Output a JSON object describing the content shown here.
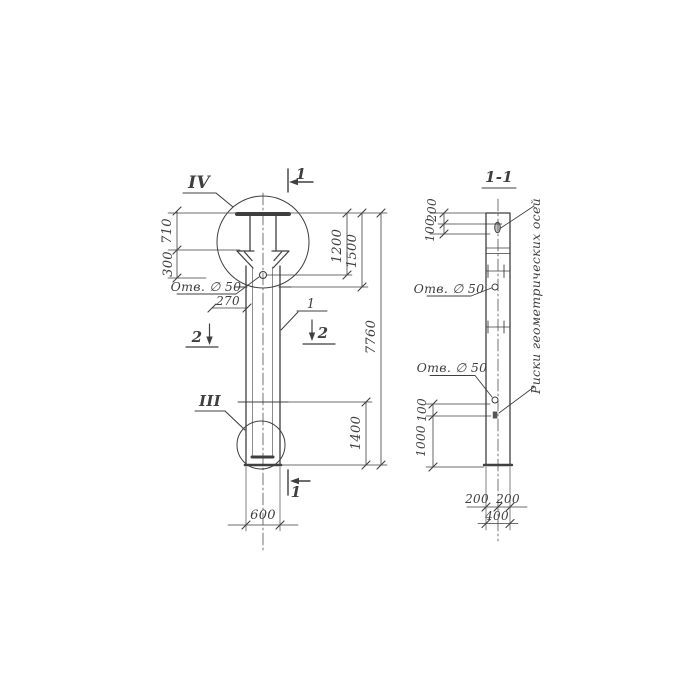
{
  "colors": {
    "ink": "#3f3f3f",
    "paper": "#ffffff"
  },
  "elevation": {
    "detail_marker_top": "IV",
    "detail_marker_bottom": "III",
    "part_number": "1",
    "section_cut_top": "1",
    "section_cut_bottom": "1",
    "section_cut_left": "2",
    "section_cut_right": "2",
    "dims": {
      "head_height": "710",
      "head_to_hole": "300",
      "hole_note": "Отв. ∅ 50",
      "hole_offset": "270",
      "top_to_hole": "1200",
      "top_to_joint": "1500",
      "overall_length": "7760",
      "lower_segment": "1400",
      "width": "600"
    }
  },
  "section_view": {
    "title": "1-1",
    "axes_note": "Риски геометрических осей",
    "dims": {
      "top_to_slot": "200",
      "slot_height": "100",
      "upper_hole_note": "Отв. ∅ 50",
      "lower_hole_note": "Отв. ∅ 50",
      "hole_to_mark": "100",
      "mark_to_base": "1000",
      "half_width_left": "200",
      "half_width_right": "200",
      "overall_width": "400"
    }
  }
}
